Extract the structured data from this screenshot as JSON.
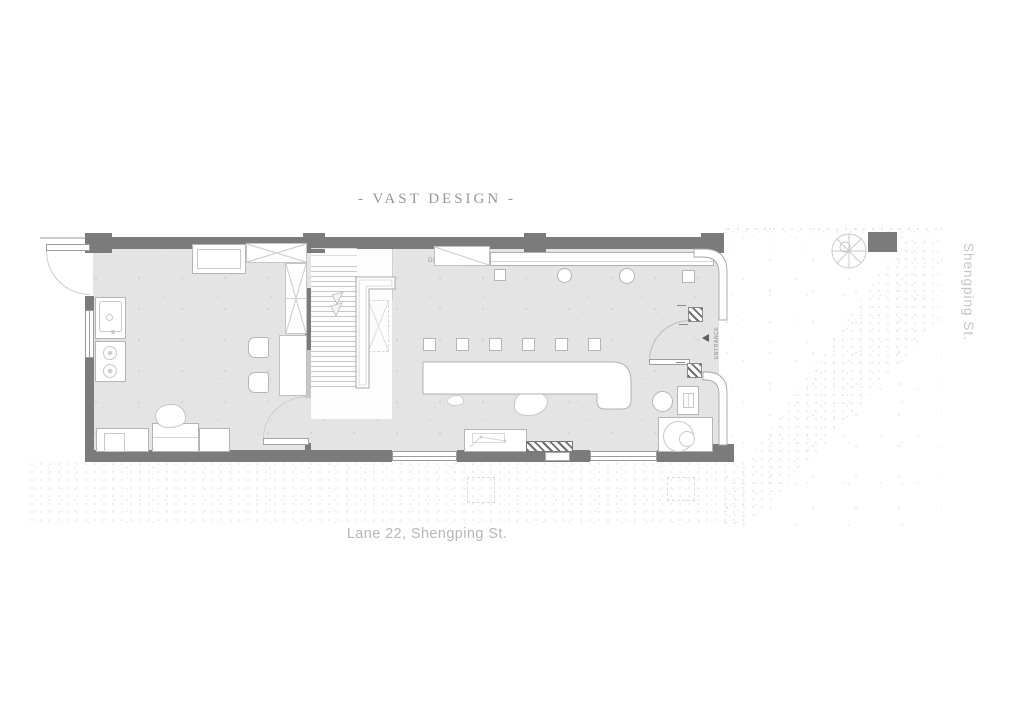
{
  "header": {
    "title": "- VAST DESIGN -"
  },
  "captions": {
    "address": "Lane 22, Shengping St.",
    "street_right": "Shengping St."
  },
  "plan": {
    "stair_direction": "DN",
    "entrance_label": "ENTRANCE"
  },
  "colors": {
    "wall": "#7b7b7c",
    "floor": "#e3e4e3",
    "furniture_outline": "#b5b5b5",
    "title_text": "#97979b",
    "caption_text": "#b5b8ba"
  }
}
